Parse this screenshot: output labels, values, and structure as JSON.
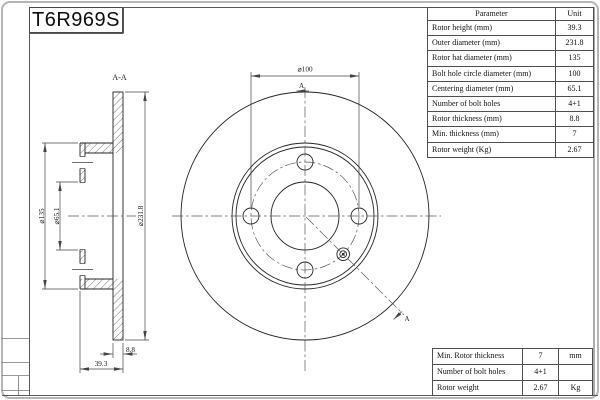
{
  "title": "T6R969S",
  "section": {
    "label": "A-A",
    "arrow": "A"
  },
  "dims": {
    "bolt_circle": "⌀100",
    "outer": "⌀231.8",
    "hat": "⌀135",
    "centering": "⌀65.1",
    "thickness": "8.8",
    "height": "39.3"
  },
  "param_table": {
    "header": {
      "param": "Parameter",
      "unit": "Unit"
    },
    "rows": [
      {
        "param": "Rotor height (mm)",
        "value": "39.3"
      },
      {
        "param": "Outer diameter (mm)",
        "value": "231.8"
      },
      {
        "param": "Rotor hat diameter (mm)",
        "value": "135"
      },
      {
        "param": "Bolt hole circle diameter (mm)",
        "value": "100"
      },
      {
        "param": "Centering diameter (mm)",
        "value": "65.1"
      },
      {
        "param": "Number of bolt holes",
        "value": "4+1"
      },
      {
        "param": "Rotor thickness (mm)",
        "value": "8.8"
      },
      {
        "param": "Min. thickness (mm)",
        "value": "7"
      },
      {
        "param": "Rotor weight (Kg)",
        "value": "2.67"
      }
    ]
  },
  "summary_table": {
    "rows": [
      {
        "name": "Min. Rotor thickness",
        "value": "7",
        "unit": "mm"
      },
      {
        "name": "Number of bolt holes",
        "value": "4+1",
        "unit": ""
      },
      {
        "name": "Rotor weight",
        "value": "2.67",
        "unit": "Kg"
      }
    ]
  }
}
